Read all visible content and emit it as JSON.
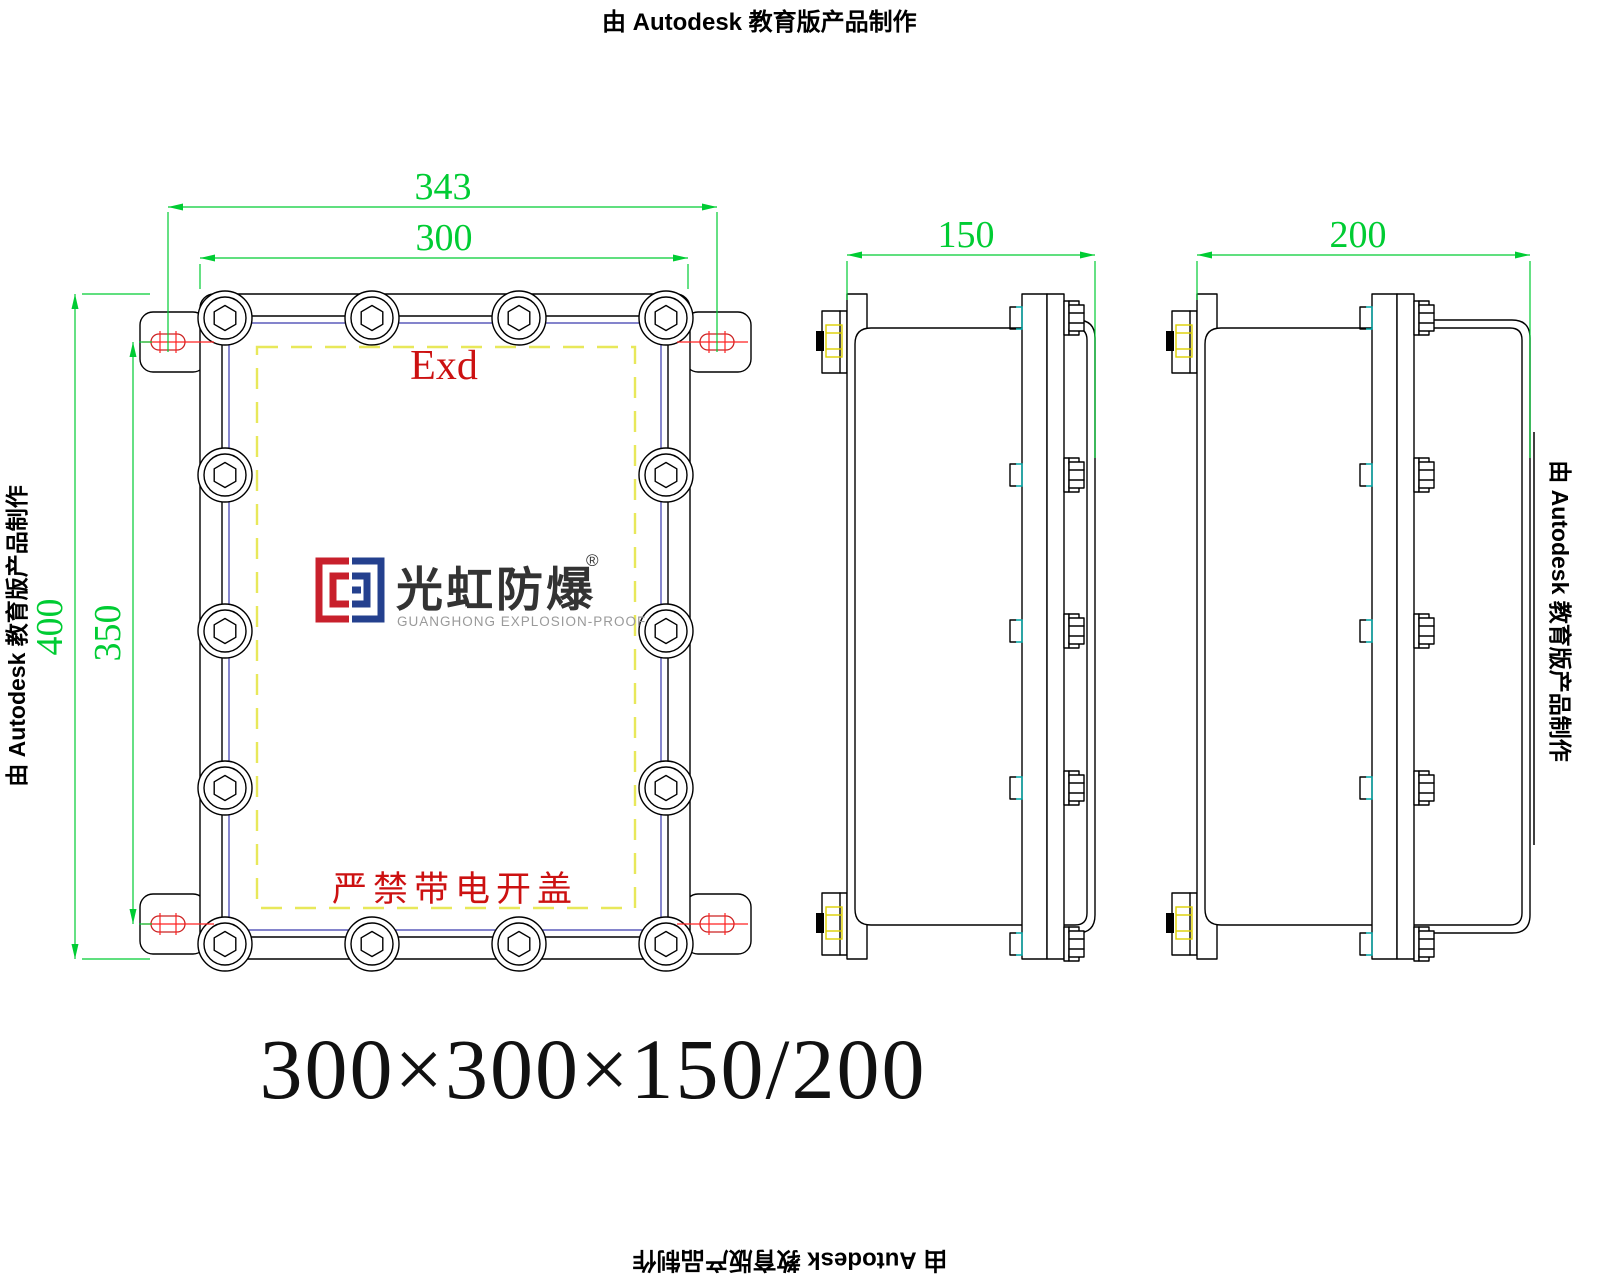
{
  "stamp": {
    "text": "由 Autodesk 教育版产品制作"
  },
  "title": {
    "text": "300×300×150/200"
  },
  "front_view": {
    "label_exd": "Exd",
    "label_warning": "严禁带电开盖",
    "dim_overall_width": "343",
    "dim_width": "300",
    "dim_overall_height": "400",
    "dim_mount_spacing": "350"
  },
  "side_view_150": {
    "dim_depth": "150"
  },
  "side_view_200": {
    "dim_depth": "200"
  },
  "logo": {
    "cn": "光虹防爆",
    "reg": "®",
    "en": "GUANGHONG EXPLOSION-PROOF"
  },
  "colors": {
    "dimension_green": "#00cc33",
    "centerline_red": "#ff2222",
    "marking_red": "#cc1111",
    "flameproof_gap_yellow": "#e8e85a",
    "bracket_bolt_yellow": "#ddd000",
    "boss_tab_cyan": "#00aaaa",
    "inner_lid_blue": "#3a3aae",
    "logo_red": "#c8202c",
    "logo_blue": "#24408e",
    "line_black": "#000000"
  }
}
